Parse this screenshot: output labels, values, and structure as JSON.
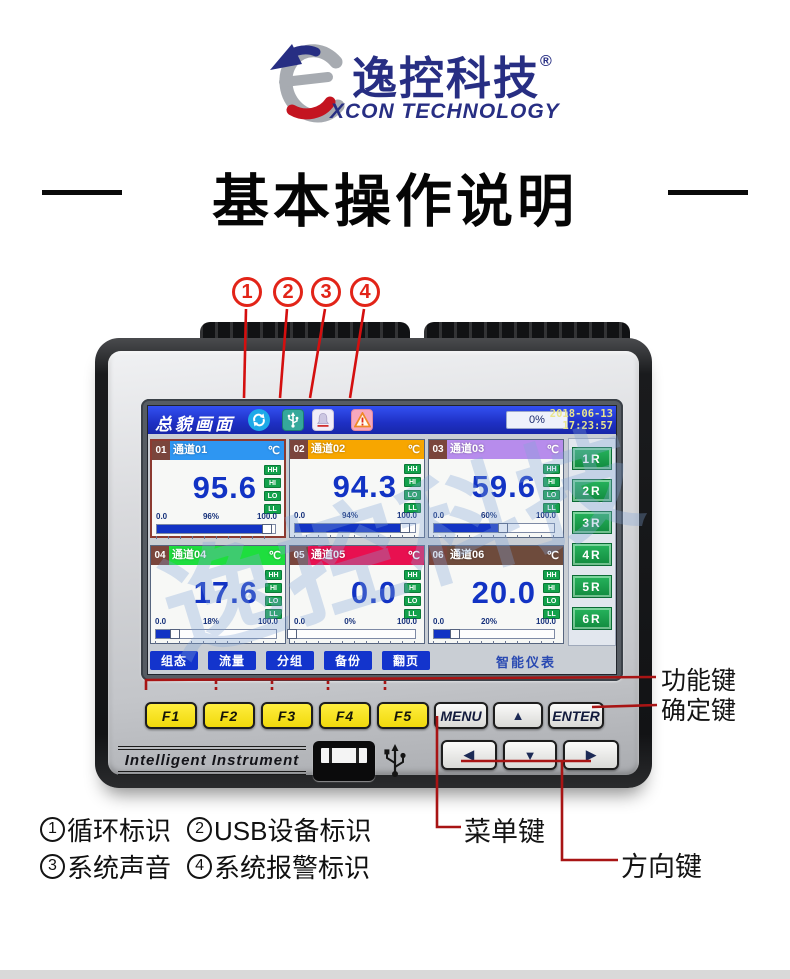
{
  "logo": {
    "brand_cn": "逸控科技",
    "reg": "®",
    "brand_en": "XCON TECHNOLOGY"
  },
  "title": "基本操作说明",
  "callouts": {
    "numbers": [
      "1",
      "2",
      "3",
      "4"
    ]
  },
  "device": {
    "screen": {
      "header": {
        "title": "总貌画面",
        "icons": [
          "cycle-icon",
          "usb-device-icon",
          "system-sound-icon",
          "system-alarm-icon"
        ],
        "progress": "0%",
        "date": "2018-06-13",
        "time": "17:23:57"
      },
      "channels": [
        {
          "no": "01",
          "name": "通道01",
          "unit": "℃",
          "value": "95.6",
          "percent": "96%",
          "min": "0.0",
          "max": "100.0",
          "color": "#2e96f2",
          "pct": 96
        },
        {
          "no": "02",
          "name": "通道02",
          "unit": "℃",
          "value": "94.3",
          "percent": "94%",
          "min": "0.0",
          "max": "100.0",
          "color": "#f7a600",
          "pct": 94
        },
        {
          "no": "03",
          "name": "通道03",
          "unit": "℃",
          "value": "59.6",
          "percent": "60%",
          "min": "0.0",
          "max": "100.0",
          "color": "#b78cec",
          "pct": 60
        },
        {
          "no": "04",
          "name": "通道04",
          "unit": "℃",
          "value": "17.6",
          "percent": "18%",
          "min": "0.0",
          "max": "100.0",
          "color": "#1ede3e",
          "pct": 18
        },
        {
          "no": "05",
          "name": "通道05",
          "unit": "℃",
          "value": "0.0",
          "percent": "0%",
          "min": "0.0",
          "max": "100.0",
          "color": "#e81050",
          "pct": 0
        },
        {
          "no": "06",
          "name": "通道06",
          "unit": "℃",
          "value": "20.0",
          "percent": "20%",
          "min": "0.0",
          "max": "100.0",
          "color": "#6e4b3c",
          "pct": 20
        }
      ],
      "alarm_badges": [
        "HH",
        "HI",
        "LO",
        "LL"
      ],
      "relay_buttons": [
        "1R",
        "2R",
        "3R",
        "4R",
        "5R",
        "6R"
      ],
      "menu_buttons": [
        "组态",
        "流量",
        "分组",
        "备份",
        "翻页"
      ],
      "brand_label": "智能仪表",
      "watermark": "逸控科技"
    },
    "keypad": {
      "function_keys": [
        "F1",
        "F2",
        "F3",
        "F4",
        "F5"
      ],
      "menu_key": "MENU",
      "up_key": "▲",
      "enter_key": "ENTER",
      "left_key": "◀",
      "down_key": "▼",
      "right_key": "▶"
    },
    "front_label": "Intelligent Instrument"
  },
  "annotations": {
    "function_keys_label": "功能键",
    "enter_key_label": "确定键",
    "menu_key_label": "菜单键",
    "direction_keys_label": "方向键"
  },
  "legend": {
    "items": [
      {
        "num": "1",
        "text": "循环标识"
      },
      {
        "num": "2",
        "text": "USB设备标识"
      },
      {
        "num": "3",
        "text": "系统声音"
      },
      {
        "num": "4",
        "text": "系统报警标识"
      }
    ]
  },
  "colors": {
    "accent_red": "#cc1111",
    "brand_navy": "#272e83",
    "screen_blue": "#2440e0",
    "key_yellow": "#f6e41e",
    "relay_green": "#17a24a",
    "value_blue": "#1233c4"
  }
}
